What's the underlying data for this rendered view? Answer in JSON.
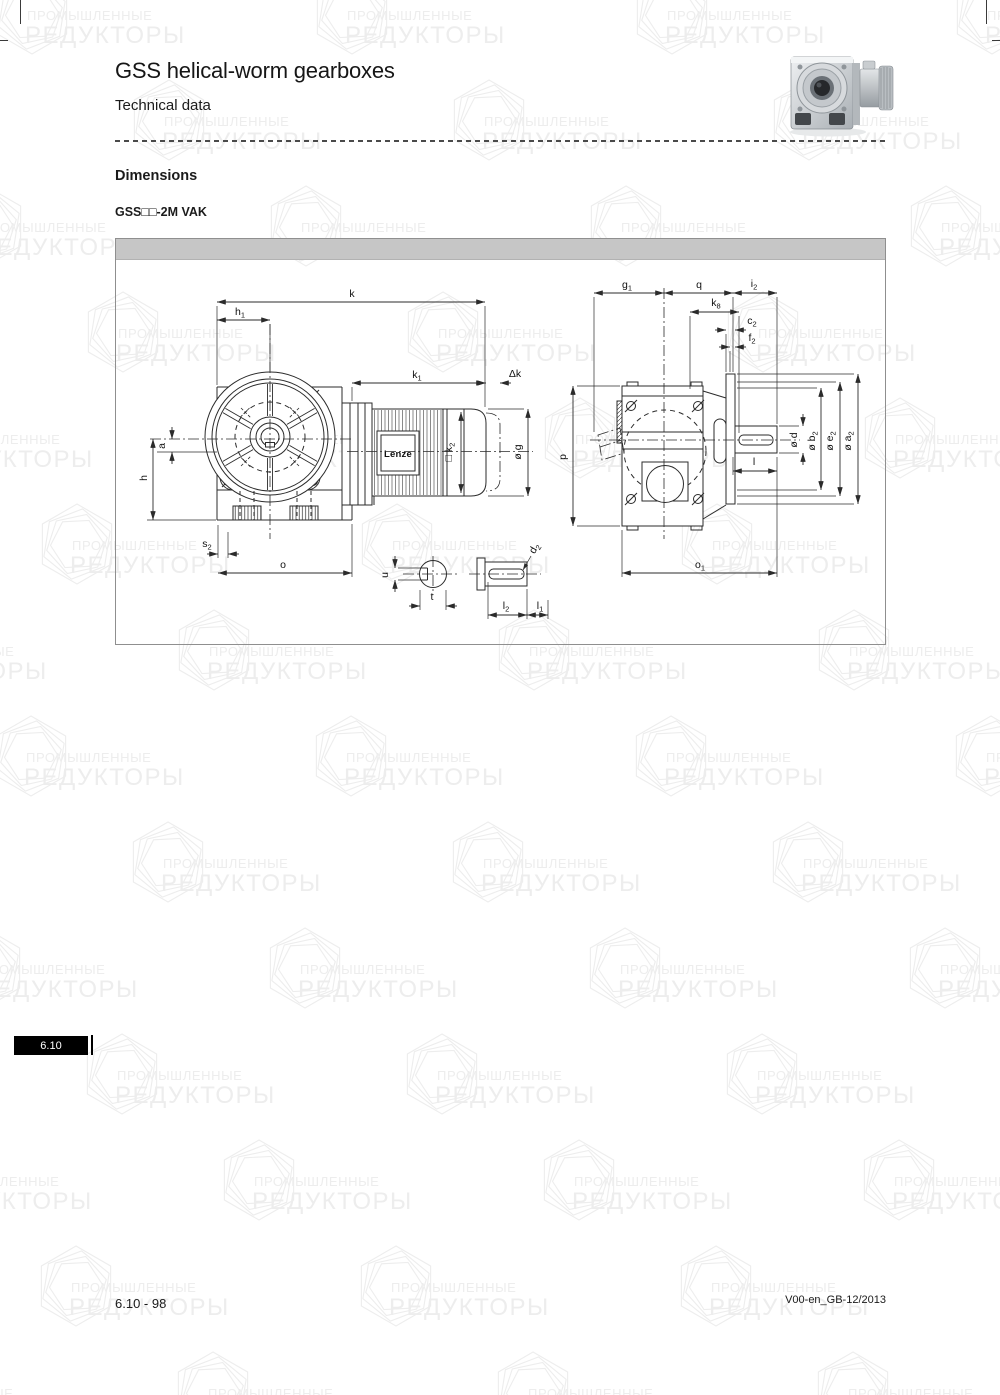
{
  "header": {
    "title": "GSS helical-worm gearboxes",
    "subtitle": "Technical data"
  },
  "section": {
    "heading": "Dimensions",
    "variant": "GSS□□-2M VAK"
  },
  "footer": {
    "left": "6.10 - 98",
    "right": "V00-en_GB-12/2013",
    "tab": "6.10"
  },
  "watermark": {
    "line1": "ПРОМЫШЛЕННЫЕ",
    "line2": "РЕДУКТОРЫ"
  },
  "colors": {
    "bar_gray": "#c6c6c6",
    "line_ink": "#2b2b2b",
    "tab_bg": "#000000",
    "watermark_gray": "#ededed"
  },
  "drawing": {
    "motor_brand": "Lenze",
    "dimensions": [
      {
        "id": "k",
        "pre": "",
        "t": "k",
        "sub": "",
        "lx": 352,
        "ly": 298,
        "rot": 0,
        "dir": "h",
        "at": 303,
        "from": 217,
        "to": 485,
        "ar": "in",
        "ext": [
          [
            217,
            307,
            217,
            386
          ],
          [
            485,
            307,
            485,
            408
          ]
        ]
      },
      {
        "id": "h1",
        "pre": "",
        "t": "h",
        "sub": "1",
        "lx": 240,
        "ly": 316,
        "rot": 0,
        "dir": "h",
        "at": 321,
        "from": 217,
        "to": 270,
        "ar": "in",
        "ext": [
          [
            270,
            325,
            270,
            372
          ]
        ]
      },
      {
        "id": "k1",
        "pre": "",
        "t": "k",
        "sub": "1",
        "lx": 417,
        "ly": 379,
        "rot": 0,
        "dir": "h",
        "at": 384,
        "from": 352,
        "to": 485,
        "ar": "in",
        "ext": [
          [
            352,
            388,
            352,
            402
          ]
        ]
      },
      {
        "id": "dk",
        "pre": "",
        "t": "Δk",
        "sub": "",
        "lx": 515,
        "ly": 378,
        "rot": 0,
        "dir": "h",
        "at": 384,
        "from": 486,
        "to": 500,
        "ar": "out",
        "ext": []
      },
      {
        "id": "k2",
        "pre": "□ ",
        "t": "k",
        "sub": "2",
        "lx": 452,
        "ly": 453,
        "rot": -90,
        "dir": "v",
        "at": 461,
        "from": 413,
        "to": 494,
        "ar": "in",
        "ext": []
      },
      {
        "id": "g",
        "pre": "ø ",
        "t": "g",
        "sub": "",
        "lx": 521,
        "ly": 453,
        "rot": -90,
        "dir": "v",
        "at": 528,
        "from": 410,
        "to": 497,
        "ar": "in",
        "ext": [
          [
            488,
            410,
            524,
            410
          ],
          [
            488,
            497,
            524,
            497
          ]
        ]
      },
      {
        "id": "a",
        "pre": "",
        "t": "a",
        "sub": "",
        "lx": 165,
        "ly": 447,
        "rot": -90,
        "dir": "v",
        "at": 172,
        "from": 440,
        "to": 453,
        "ar": "out",
        "ext": [
          [
            157,
            453,
            217,
            453
          ]
        ]
      },
      {
        "id": "h",
        "pre": "",
        "t": "h",
        "sub": "",
        "lx": 147,
        "ly": 479,
        "rot": -90,
        "dir": "v",
        "at": 153,
        "from": 440,
        "to": 521,
        "ar": "in",
        "ext": [
          [
            147,
            521,
            216,
            521
          ]
        ]
      },
      {
        "id": "s2",
        "pre": "",
        "t": "s",
        "sub": "2",
        "lx": 207,
        "ly": 548,
        "rot": 0,
        "dir": "h",
        "at": 555,
        "from": 218,
        "to": 228,
        "ar": "out",
        "ext": [
          [
            218,
            526,
            218,
            559
          ],
          [
            228,
            533,
            228,
            559
          ]
        ]
      },
      {
        "id": "o",
        "pre": "",
        "t": "o",
        "sub": "",
        "lx": 283,
        "ly": 569,
        "rot": 0,
        "dir": "h",
        "at": 574,
        "from": 218,
        "to": 352,
        "ar": "in",
        "ext": [
          [
            352,
            525,
            352,
            578
          ]
        ]
      },
      {
        "id": "u",
        "pre": "",
        "t": "u",
        "sub": "",
        "lx": 388,
        "ly": 576,
        "rot": -90,
        "dir": "v",
        "at": 395,
        "from": 569,
        "to": 581,
        "ar": "out",
        "ext": [
          [
            398,
            569,
            421,
            569
          ],
          [
            398,
            581,
            421,
            581
          ]
        ]
      },
      {
        "id": "t",
        "pre": "",
        "t": "t",
        "sub": "",
        "lx": 432,
        "ly": 601,
        "rot": 0,
        "dir": "h",
        "at": 607,
        "from": 420,
        "to": 446,
        "ar": "out",
        "ext": [
          [
            420,
            591,
            420,
            611
          ],
          [
            446,
            591,
            446,
            611
          ]
        ]
      },
      {
        "id": "d2",
        "pre": "",
        "t": "d",
        "sub": "2",
        "lx": 537,
        "ly": 551,
        "rot": -60,
        "dir": "none",
        "at": 0,
        "from": 0,
        "to": 0,
        "ar": "in",
        "ext": [
          [
            531,
            557,
            523,
            571
          ]
        ]
      },
      {
        "id": "l2",
        "pre": "",
        "t": "l",
        "sub": "2",
        "lx": 506,
        "ly": 610,
        "rot": 0,
        "dir": "h",
        "at": 616,
        "from": 488,
        "to": 527,
        "ar": "in",
        "ext": [
          [
            488,
            583,
            488,
            620
          ],
          [
            527,
            590,
            527,
            620
          ]
        ]
      },
      {
        "id": "l1",
        "pre": "",
        "t": "l",
        "sub": "1",
        "lx": 540,
        "ly": 610,
        "rot": 0,
        "dir": "h",
        "at": 616,
        "from": 527,
        "to": 548,
        "ar": "in",
        "ext": [
          [
            548,
            601,
            548,
            620
          ]
        ]
      },
      {
        "id": "g1",
        "pre": "",
        "t": "g",
        "sub": "1",
        "lx": 627,
        "ly": 289,
        "rot": 0,
        "dir": "h",
        "at": 294,
        "from": 594,
        "to": 664,
        "ar": "in",
        "ext": [
          [
            594,
            298,
            594,
            433
          ]
        ]
      },
      {
        "id": "q",
        "pre": "",
        "t": "q",
        "sub": "",
        "lx": 699,
        "ly": 289,
        "rot": 0,
        "dir": "h",
        "at": 294,
        "from": 664,
        "to": 733,
        "ar": "in",
        "ext": [
          [
            733,
            298,
            733,
            373
          ]
        ]
      },
      {
        "id": "i2",
        "pre": "",
        "t": "i",
        "sub": "2",
        "lx": 754,
        "ly": 288,
        "rot": 0,
        "dir": "h",
        "at": 294,
        "from": 733,
        "to": 777,
        "ar": "in",
        "ext": [
          [
            777,
            298,
            777,
            425
          ]
        ]
      },
      {
        "id": "k8",
        "pre": "",
        "t": "k",
        "sub": "8",
        "lx": 716,
        "ly": 307,
        "rot": 0,
        "dir": "h",
        "at": 313,
        "from": 690,
        "to": 739,
        "ar": "in",
        "ext": [
          [
            690,
            317,
            690,
            390
          ],
          [
            739,
            317,
            739,
            434
          ]
        ]
      },
      {
        "id": "c2",
        "pre": "",
        "t": "c",
        "sub": "2",
        "lx": 752,
        "ly": 325,
        "rot": 0,
        "dir": "h",
        "at": 331,
        "from": 726,
        "to": 735,
        "ar": "out",
        "ext": [
          [
            726,
            335,
            726,
            373
          ]
        ]
      },
      {
        "id": "f2",
        "pre": "",
        "t": "f",
        "sub": "2",
        "lx": 752,
        "ly": 342,
        "rot": 0,
        "dir": "h",
        "at": 348,
        "from": 730,
        "to": 735,
        "ar": "out",
        "ext": [
          [
            730,
            352,
            730,
            373
          ]
        ]
      },
      {
        "id": "p",
        "pre": "",
        "t": "p",
        "sub": "",
        "lx": 566,
        "ly": 458,
        "rot": -90,
        "dir": "v",
        "at": 573,
        "from": 387,
        "to": 527,
        "ar": "in",
        "ext": [
          [
            577,
            387,
            620,
            387
          ],
          [
            577,
            527,
            620,
            527
          ]
        ]
      },
      {
        "id": "d",
        "pre": "ø ",
        "t": "d",
        "sub": "",
        "lx": 797,
        "ly": 441,
        "rot": -90,
        "dir": "v",
        "at": 803,
        "from": 427,
        "to": 454,
        "ar": "out",
        "ext": [
          [
            779,
            427,
            799,
            427
          ],
          [
            779,
            454,
            799,
            454
          ]
        ]
      },
      {
        "id": "b2",
        "pre": "ø ",
        "t": "b",
        "sub": "2",
        "lx": 815,
        "ly": 442,
        "rot": -90,
        "dir": "v",
        "at": 821,
        "from": 389,
        "to": 491,
        "ar": "in",
        "ext": [
          [
            737,
            389,
            817,
            389
          ],
          [
            737,
            491,
            817,
            491
          ]
        ]
      },
      {
        "id": "e2",
        "pre": "ø ",
        "t": "e",
        "sub": "2",
        "lx": 833,
        "ly": 442,
        "rot": -90,
        "dir": "v",
        "at": 840,
        "from": 383,
        "to": 497,
        "ar": "in",
        "ext": [
          [
            737,
            383,
            836,
            383
          ],
          [
            737,
            497,
            836,
            497
          ]
        ]
      },
      {
        "id": "a2",
        "pre": "ø ",
        "t": "a",
        "sub": "2",
        "lx": 851,
        "ly": 442,
        "rot": -90,
        "dir": "v",
        "at": 858,
        "from": 375,
        "to": 505,
        "ar": "in",
        "ext": [
          [
            737,
            375,
            854,
            375
          ],
          [
            737,
            505,
            854,
            505
          ]
        ]
      },
      {
        "id": "l",
        "pre": "",
        "t": "l",
        "sub": "",
        "lx": 754,
        "ly": 466,
        "rot": 0,
        "dir": "h",
        "at": 472,
        "from": 733,
        "to": 777,
        "ar": "in",
        "ext": [
          [
            733,
            458,
            733,
            476
          ]
        ]
      },
      {
        "id": "o1",
        "pre": "",
        "t": "o",
        "sub": "1",
        "lx": 700,
        "ly": 569,
        "rot": 0,
        "dir": "h",
        "at": 574,
        "from": 622,
        "to": 777,
        "ar": "in",
        "ext": [
          [
            622,
            531,
            622,
            578
          ],
          [
            777,
            458,
            777,
            578
          ]
        ]
      }
    ]
  }
}
